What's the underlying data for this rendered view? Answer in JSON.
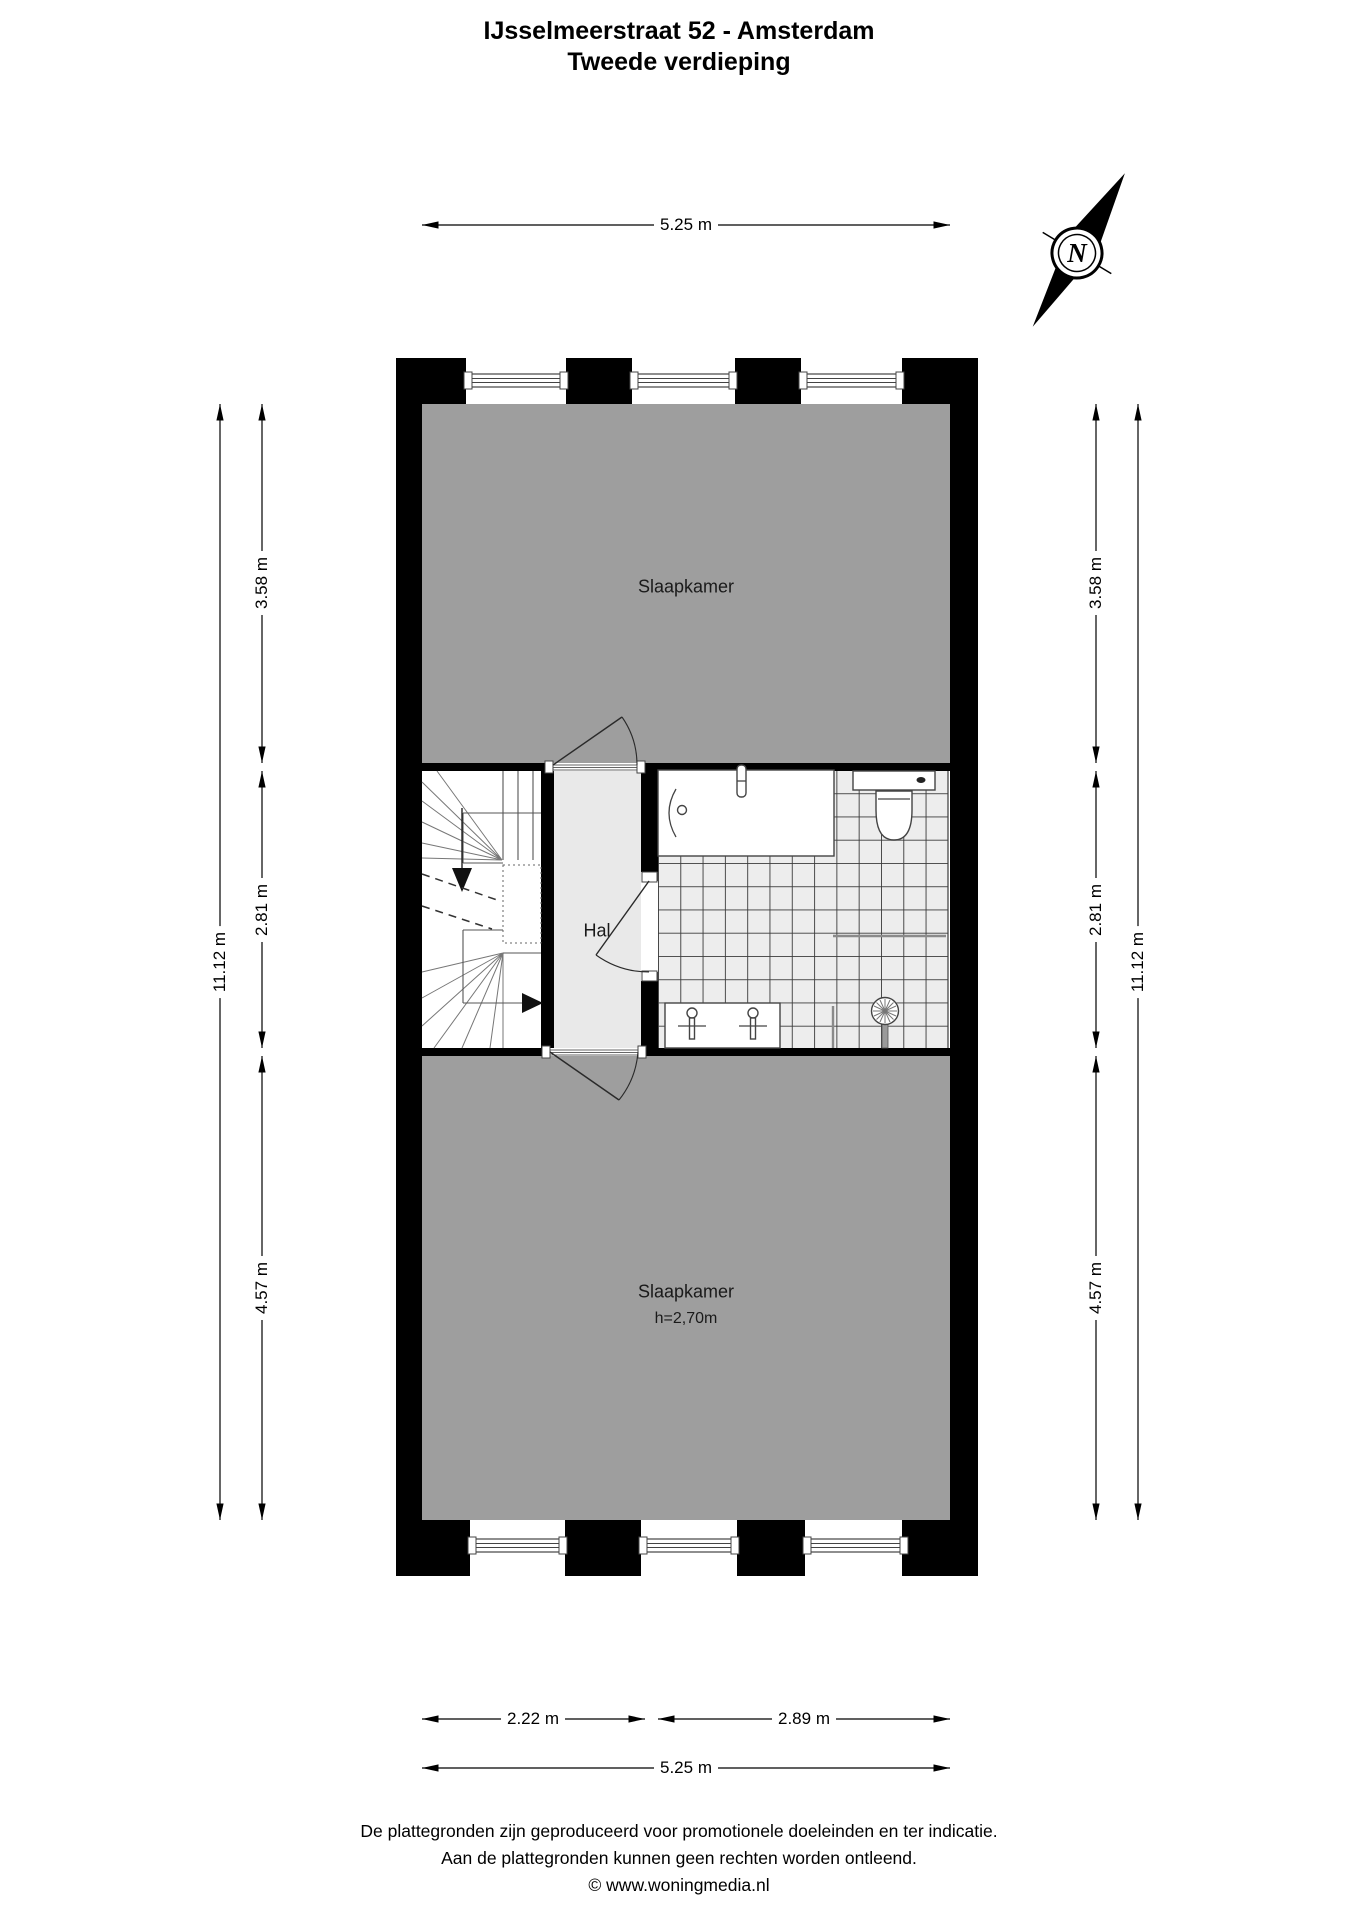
{
  "title": {
    "line1": "IJsselmeerstraat 52 - Amsterdam",
    "line2": "Tweede verdieping"
  },
  "compass": {
    "label": "N"
  },
  "rooms": {
    "bedroom_top": {
      "label": "Slaapkamer"
    },
    "hall": {
      "label": "Hal"
    },
    "bedroom_bottom": {
      "label": "Slaapkamer",
      "ceiling_height": "h=2,70m"
    }
  },
  "dimensions": {
    "top_total": "5.25 m",
    "left_total": "11.12 m",
    "right_total": "11.12 m",
    "left_segments": [
      "3.58 m",
      "2.81 m",
      "4.57 m"
    ],
    "right_segments": [
      "3.58 m",
      "2.81 m",
      "4.57 m"
    ],
    "bottom_left": "2.22 m",
    "bottom_right": "2.89 m",
    "bottom_total": "5.25 m"
  },
  "footer": {
    "line1": "De plattegronden zijn geproduceerd voor promotionele doeleinden en ter indicatie.",
    "line2": "Aan de plattegronden kunnen geen rechten worden ontleend.",
    "line3": "© www.woningmedia.nl"
  },
  "colors": {
    "wall": "#000000",
    "room_fill": "#9e9e9e",
    "hall_fill": "#e9e9e9",
    "tile_bg": "#ededed",
    "tile_line": "#3a3a3a",
    "fixture_line": "#444444"
  }
}
